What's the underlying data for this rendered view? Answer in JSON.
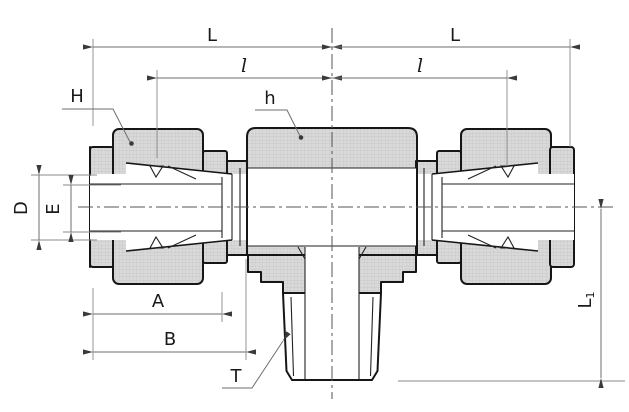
{
  "drawing": {
    "labels": {
      "L_left": "L",
      "L_right": "L",
      "ell_left": "l",
      "ell_right": "l",
      "H": "H",
      "h": "h",
      "D": "D",
      "E": "E",
      "A": "A",
      "B": "B",
      "T": "T",
      "L1_main": "L",
      "L1_sub": "1"
    },
    "colors": {
      "background": "#ffffff",
      "part_fill": "#d9d9d9",
      "hatch_line": "#c4c4c4",
      "outline": "#161616",
      "dimension_line": "#6e6e6e",
      "label_text": "#1a1a1a"
    }
  }
}
